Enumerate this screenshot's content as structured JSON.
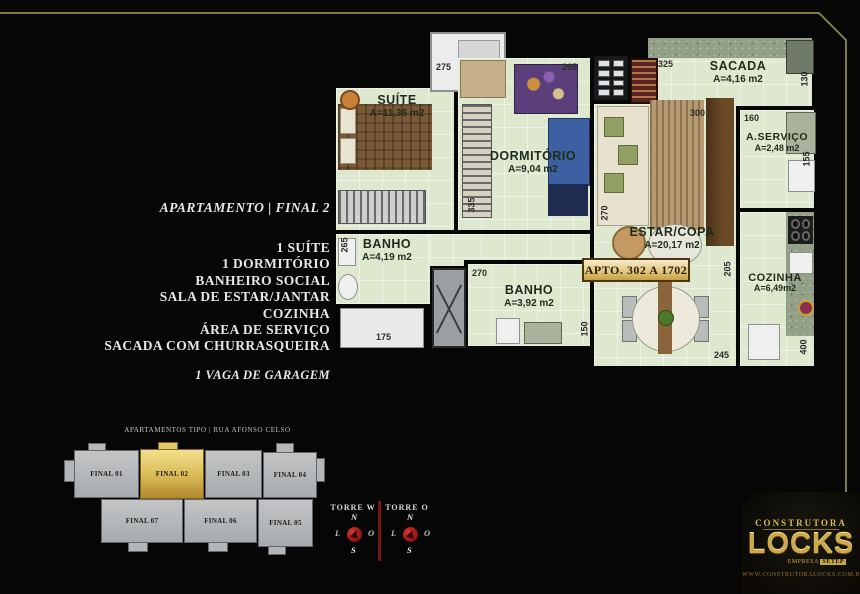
{
  "page": {
    "background": "#060606",
    "frame_color": "#7c7c4a"
  },
  "info_panel": {
    "title": "APARTAMENTO | FINAL 2",
    "features": [
      "1 SUÍTE",
      "1 DORMITÓRIO",
      "BANHEIRO SOCIAL",
      "SALA DE ESTAR/JANTAR",
      "COZINHA",
      "ÁREA DE SERVIÇO",
      "SACADA COM CHURRASQUEIRA"
    ],
    "garage": "1 VAGA DE GARAGEM"
  },
  "floor_plan": {
    "apto_badge": "APTO. 302 A 1702",
    "rooms": [
      {
        "name": "SUÍTE",
        "area": "A=11,36 m2"
      },
      {
        "name": "DORMITÓRIO",
        "area": "A=9,04 m2"
      },
      {
        "name": "SACADA",
        "area": "A=4,16 m2"
      },
      {
        "name": "A.SERVIÇO",
        "area": "A=2,48 m2"
      },
      {
        "name": "ESTAR/COPA",
        "area": "A=20,17 m2"
      },
      {
        "name": "COZINHA",
        "area": "A=6,49m2"
      },
      {
        "name": "BANHO",
        "area": "A=4,19 m2"
      },
      {
        "name": "BANHO",
        "area": "A=3,92 m2"
      }
    ],
    "dimensions": {
      "d325": "325",
      "d275": "275",
      "d265_top": "265",
      "d300": "300",
      "d160": "160",
      "d130": "130",
      "d155": "155",
      "d335": "335",
      "d265_left": "265",
      "d270_estar": "270",
      "d270_banho": "270",
      "d205": "205",
      "d175": "175",
      "d150": "150",
      "d245": "245",
      "d400": "400"
    }
  },
  "building_diagram": {
    "header": "APARTAMENTOS TIPO | RUA AFONSO CELSO",
    "highlight_color": "#d9b954",
    "units": [
      {
        "label": "FINAL 01"
      },
      {
        "label": "FINAL 02"
      },
      {
        "label": "FINAL 03"
      },
      {
        "label": "FINAL 04"
      },
      {
        "label": "FINAL 07"
      },
      {
        "label": "FINAL 06"
      },
      {
        "label": "FINAL 05"
      }
    ]
  },
  "compass": {
    "tower_w": "TORRE W",
    "tower_o": "TORRE O",
    "north": "N",
    "south": "S",
    "east": "L",
    "west": "O"
  },
  "logo": {
    "brand_top": "CONSTRUTORA",
    "brand_name": "LOCKS",
    "sub_prefix": "EMPRESA",
    "sub_chip": "SETEP",
    "url": "WWW.CONSTRUTORALOCKS.COM.BR",
    "gold": "#cfa94c"
  }
}
